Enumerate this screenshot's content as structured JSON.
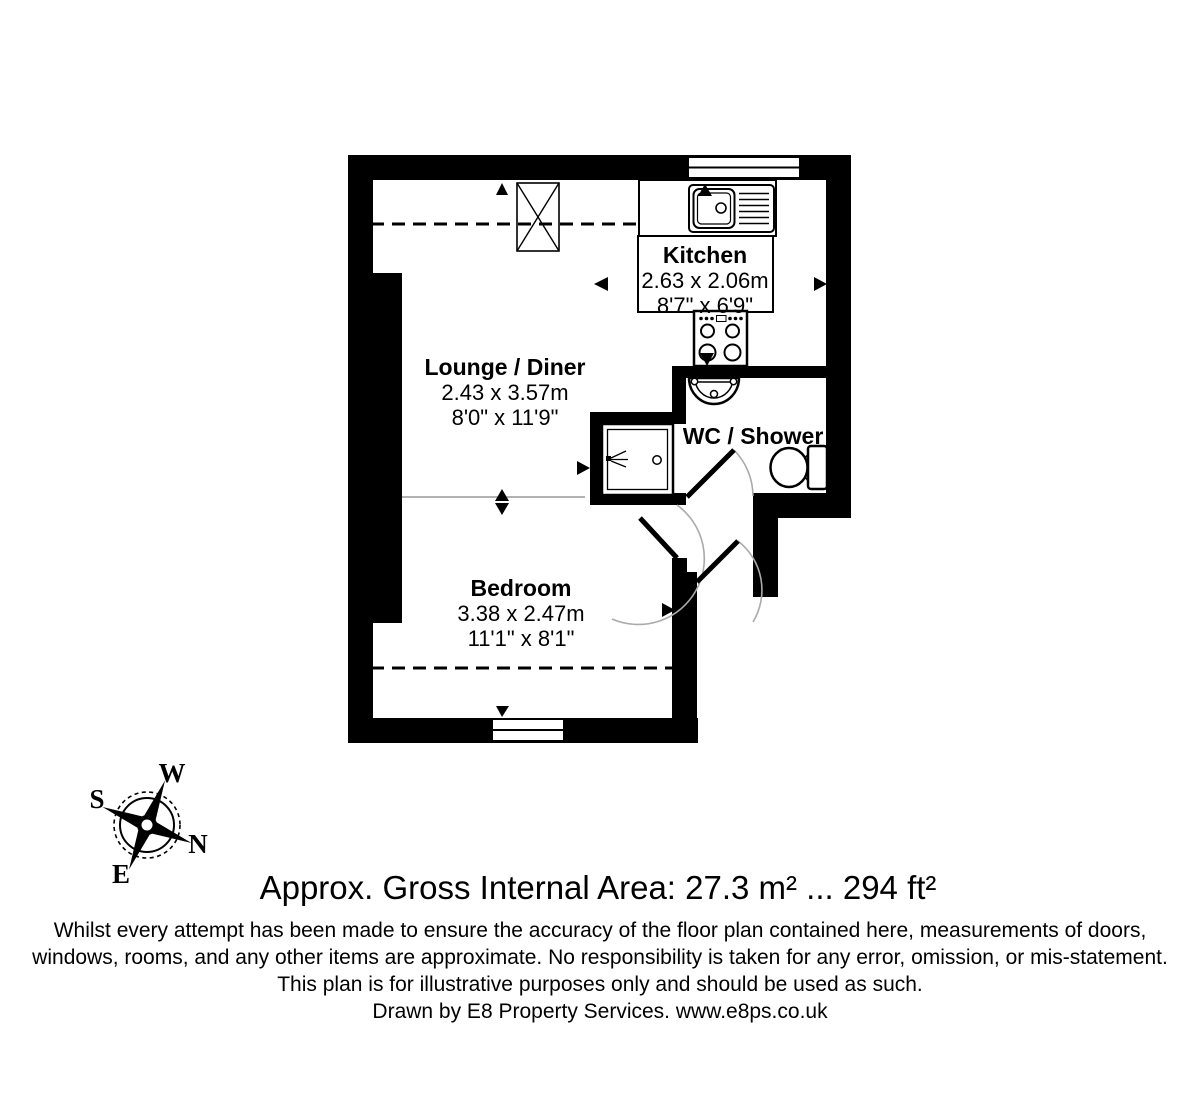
{
  "floorplan": {
    "rooms": {
      "kitchen": {
        "name": "Kitchen",
        "metric": "2.63 x 2.06m",
        "imperial": "8'7\" x 6'9\""
      },
      "lounge": {
        "name": "Lounge / Diner",
        "metric": "2.43 x 3.57m",
        "imperial": "8'0\" x 11'9\""
      },
      "wc": {
        "name": "WC / Shower"
      },
      "bedroom": {
        "name": "Bedroom",
        "metric": "3.38 x 2.47m",
        "imperial": "11'1\" x 8'1\""
      }
    },
    "colors": {
      "wall": "#000000",
      "background": "#ffffff",
      "door_arc": "#aaaaaa",
      "divider": "#999999"
    }
  },
  "compass": {
    "west": "W",
    "south": "S",
    "north": "N",
    "east": "E"
  },
  "footer": {
    "area_line": "Approx. Gross Internal Area: 27.3 m² ... 294 ft²",
    "disclaimer_lines": [
      "Whilst every attempt has been made to ensure the accuracy of the floor plan contained here, measurements of doors,",
      "windows, rooms, and any other items are approximate. No responsibility is taken for any error, omission, or mis-statement.",
      "This plan is for illustrative purposes only and should be used as such.",
      "Drawn by E8 Property Services. www.e8ps.co.uk"
    ]
  }
}
